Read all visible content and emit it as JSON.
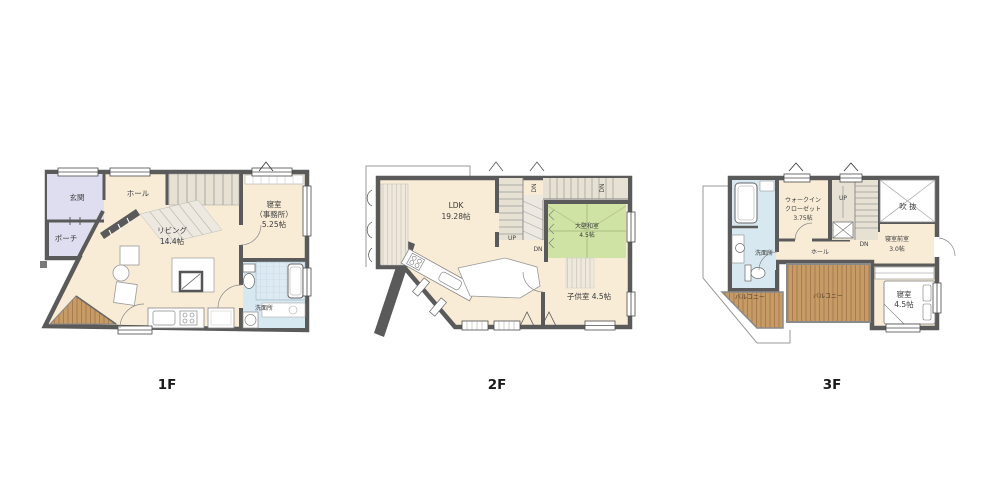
{
  "page": {
    "background": "#ffffff"
  },
  "colors": {
    "wall": "#5a5a5a",
    "floor_cream": "#f8ecd7",
    "entrance_lavender": "#dfdef0",
    "water_blue": "#d8e8f0",
    "tatami_green": "#cfe3a5",
    "deck_wood": "#c79b66",
    "stair_beige": "#e6e1d3"
  },
  "floors": [
    {
      "label": "1F",
      "rooms": {
        "entrance": "玄関",
        "porch": "ポーチ",
        "hall": "ホール",
        "living_name": "リビング",
        "living_size": "14.4帖",
        "bedroom_name": "寝室",
        "bedroom_sub": "（事務所）",
        "bedroom_size": "5.25帖",
        "washroom": "洗面所"
      }
    },
    {
      "label": "2F",
      "rooms": {
        "ldk_name": "LDK",
        "ldk_size": "19.28帖",
        "washitsu_name": "大壁和室",
        "washitsu_size": "4.5帖",
        "kids_room": "子供室 4.5帖"
      },
      "stairs": {
        "up": "UP",
        "dn": "DN",
        "dn_upper_left": "DN",
        "dn_upper_right": "DN"
      }
    },
    {
      "label": "3F",
      "rooms": {
        "wic_line1": "ウォークイン",
        "wic_line2": "クローゼット",
        "wic_size": "3.75帖",
        "void": "吹 抜",
        "anteroom_name": "寝室前室",
        "anteroom_size": "3.0帖",
        "washroom": "洗面所",
        "hall": "ホール",
        "balcony_left": "バルコニー",
        "balcony_main": "バルコニー",
        "bedroom_name": "寝室",
        "bedroom_size": "4.5帖"
      },
      "stairs": {
        "up": "UP",
        "dn": "DN"
      }
    }
  ]
}
